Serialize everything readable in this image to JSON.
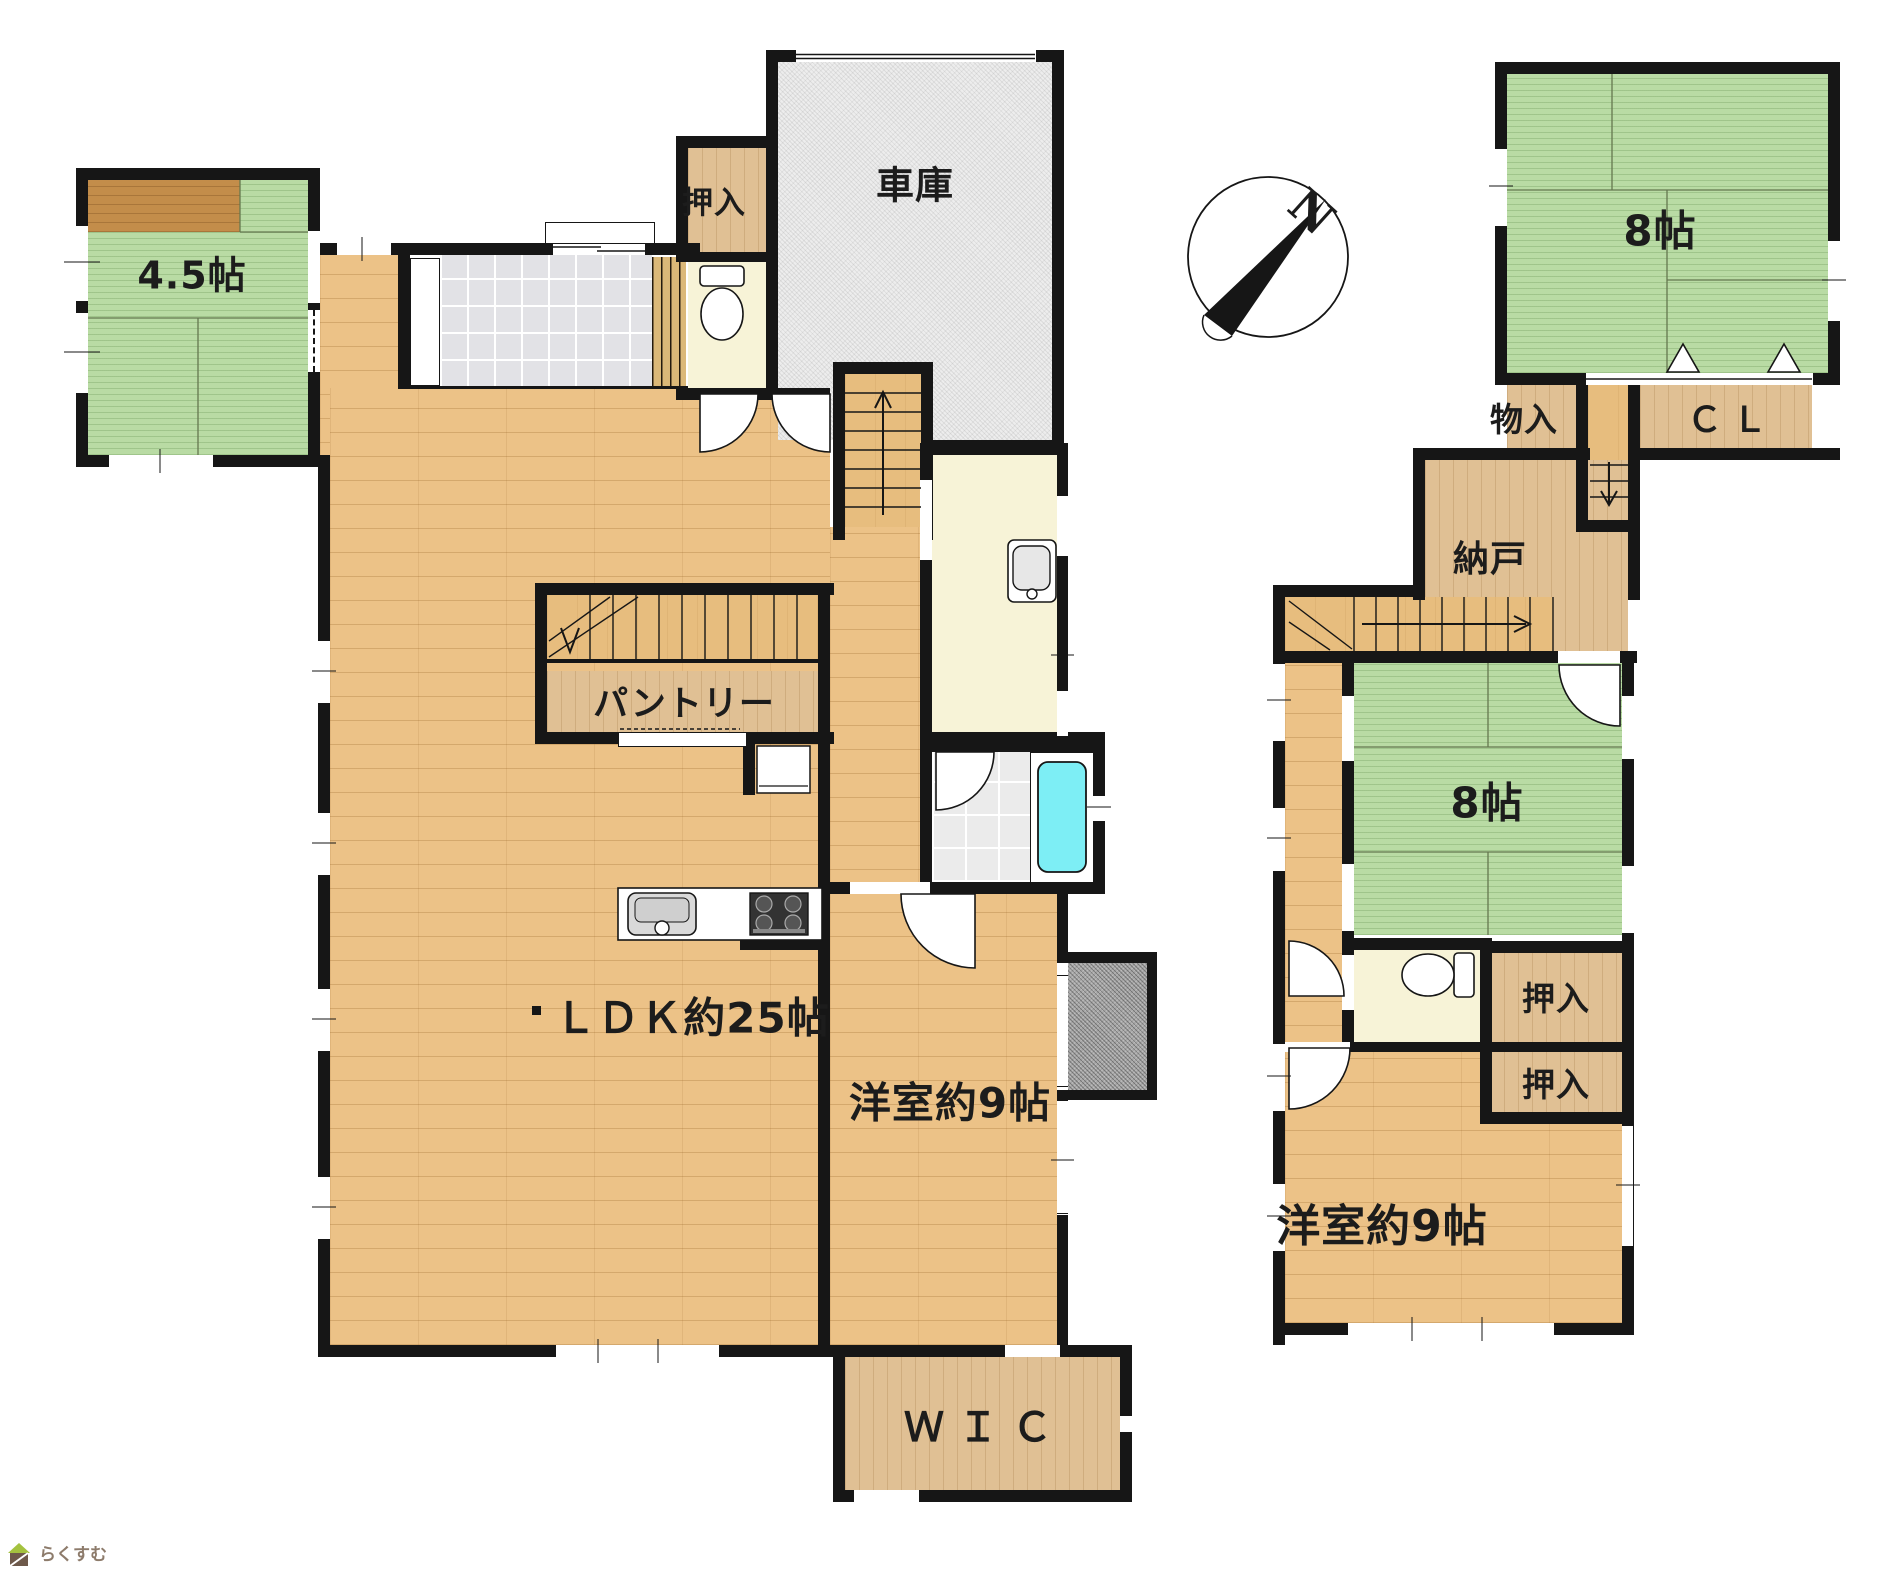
{
  "floor1": {
    "tatami45": "4.5帖",
    "oshiire": "押入",
    "garage": "車庫",
    "pantry": "パントリー",
    "ldk": "ＬＤＫ約25帖",
    "western": "洋室約9帖",
    "wic": "ＷＩＣ"
  },
  "floor2": {
    "tatami8_north": "8帖",
    "monoire": "物入",
    "cl": "ＣＬ",
    "nando": "納戸",
    "tatami8_south": "8帖",
    "oshiire_upper": "押入",
    "oshiire_lower": "押入",
    "western": "洋室約9帖"
  },
  "compass": {
    "north": "N"
  },
  "logo": {
    "text": "らくすむ"
  },
  "colors": {
    "wall": "#161616",
    "tatami": "#b9dba4",
    "wood_floor": "#ecc287",
    "closet_wood": "#e0c094",
    "garage": "#ededed",
    "entry_tile": "#e2e2e6",
    "wet_room": "#f7f3d7",
    "bathtub": "#7deef5",
    "balcony": "#a6a6a6"
  }
}
